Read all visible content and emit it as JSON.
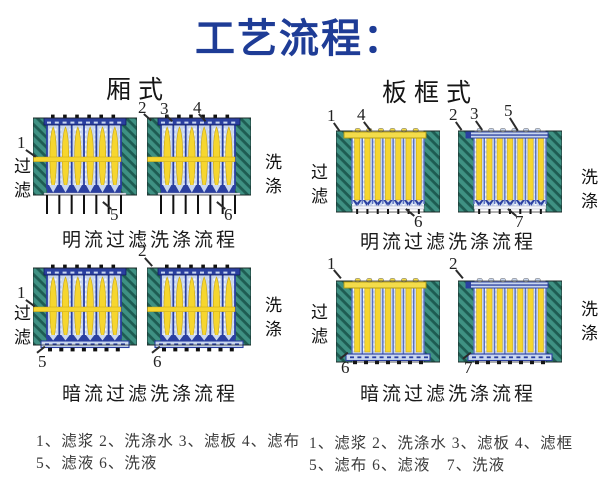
{
  "title": "工艺流程：",
  "chamber": {
    "header": "厢式",
    "open": {
      "caption": "明流过滤洗涤流程",
      "filter": "过滤",
      "wash": "洗涤",
      "m1": "1",
      "m2": "2",
      "m3": "3",
      "m4": "4",
      "m5": "5",
      "m6": "6"
    },
    "closed": {
      "caption": "暗流过滤洗涤流程",
      "filter": "过滤",
      "wash": "洗涤",
      "m1": "1",
      "m2": "2",
      "m5": "5",
      "m6": "6"
    },
    "legend1": "1、滤浆 2、洗涤水 3、滤板 4、滤布",
    "legend2": "5、滤液 6、洗液"
  },
  "frame": {
    "header": "板框式",
    "open": {
      "caption": "明流过滤洗涤流程",
      "filter": "过滤",
      "wash": "洗涤",
      "m1": "1",
      "m2": "2",
      "m3": "3",
      "m4": "4",
      "m5": "5",
      "m6": "6",
      "m7": "7"
    },
    "closed": {
      "caption": "暗流过滤洗涤流程",
      "filter": "过滤",
      "wash": "洗涤",
      "m1": "1",
      "m2": "2",
      "m6": "6",
      "m7": "7"
    },
    "legend1": "1、滤浆 2、洗涤水 3、滤板 4、滤框",
    "legend2": "5、滤布 6、滤液　7、洗液"
  },
  "colors": {
    "title_blue": "#1e3c96",
    "end_plate_teal": "#3f9183",
    "cake_yellow": "#f6d62e",
    "filter_plate_blue": "#c9d7ef",
    "frame_dark_blue": "#2a3fa0"
  }
}
